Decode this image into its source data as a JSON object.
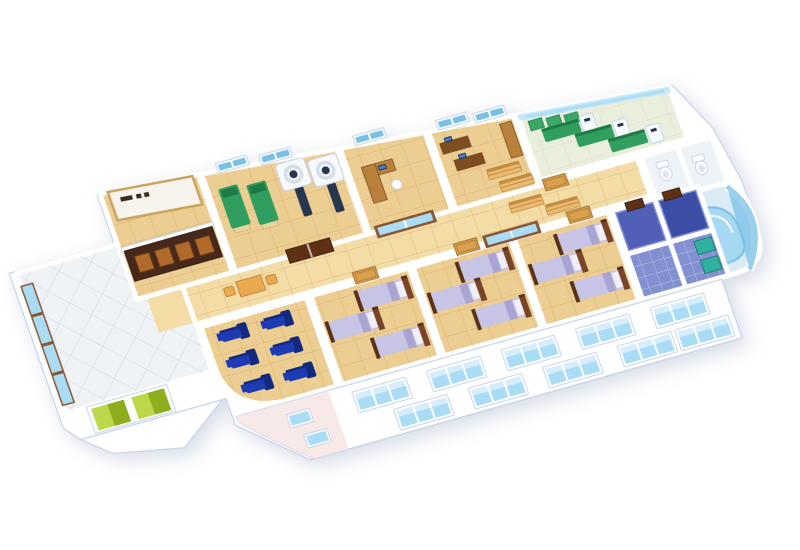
{
  "meta": {
    "description": "3D isometric cutaway floor-plan render of a hospital ward floor on a white background",
    "view": "isometric cutaway, rotated about -19 degrees",
    "reception_sign_text_legible": false
  },
  "colors": {
    "page_bg": "#ffffff",
    "slab": "#ffffff",
    "wall_edge": "#c7d4e8",
    "floor_tan": "#eccd92",
    "floor_grid": "#c89a52",
    "corridor_tan": "#f3dca6",
    "lobby_floor": "#f0f3f6",
    "lobby_grid": "#c6cfda",
    "glass": "#aadcf5",
    "glass_light": "#d6eefb",
    "glass_dark": "#79c0e6",
    "frame_brown": "#8a5633",
    "door_brown": "#5f3014",
    "door_tan": "#d9a14f",
    "exam_green": "#2f9e5f",
    "exam_green_dark": "#1e7a45",
    "base_wood": "#e9d3a0",
    "scanner_white": "#f7fafd",
    "scanner_dark": "#26364f",
    "scanner_ring": "#d4dde8",
    "desk_wood": "#b9803c",
    "desk_dark": "#7c4e22",
    "monitor": "#3e82dd",
    "bench": "#e9ba72",
    "bench_dark": "#c48c3f",
    "treat_wall": "#c3e9f7",
    "treat_floor": "#eaefdd",
    "screen_green": "#3aa868",
    "wc_floor": "#eef3f8",
    "pool_deck": "#d9ecf6",
    "pool_water": "#a7d8f3",
    "pool_deep": "#7cc0e7",
    "pool_rim": "#f2f9fd",
    "recliner": "#1d3cb4",
    "recliner_deep": "#12297f",
    "bed_wood": "#7a4426",
    "bed_wood_dark": "#5a3016",
    "blanket": "#c8c4e5",
    "blanket_dark": "#a9a4d1",
    "pillow": "#f1eff9",
    "bath_floor": "#8290d1",
    "bath_deep": "#5160b6",
    "navy": "#3c4da6",
    "teal": "#2fb0a0",
    "elev_green": "#bcd84a",
    "elev_dark": "#8fae1e",
    "pink": "#f7e5e5",
    "sign_bg": "#f7f4ee",
    "sign_ink": "#3a2c1d",
    "counter": "#46291a",
    "counter_panel": "#b06a2c",
    "table_orange": "#e9a94f",
    "table_dark": "#b97a2e"
  },
  "building": {
    "rooms": [
      {
        "id": "lobby",
        "name": "entrance-lobby",
        "floor": "white-diagonal-tile",
        "features": [
          "reception-counter",
          "reception-sign",
          "window-wall",
          "elevator-doors"
        ]
      },
      {
        "id": "imaging-room",
        "name": "imaging-room",
        "floor": "tan-tile",
        "furniture": [
          {
            "type": "exam-bed-green",
            "count": 2
          },
          {
            "type": "ct-scanner",
            "count": 2
          },
          {
            "type": "double-door-brown",
            "count": 1
          },
          {
            "type": "back-wall-window",
            "count": 2
          }
        ]
      },
      {
        "id": "consult-office",
        "name": "consultation-office",
        "floor": "tan-tile",
        "furniture": [
          {
            "type": "desk-l-shaped",
            "count": 1
          },
          {
            "type": "computer-monitor",
            "count": 1
          },
          {
            "type": "office-chair",
            "count": 1
          },
          {
            "type": "glass-sliding-door",
            "count": 1
          },
          {
            "type": "back-wall-window",
            "count": 1
          }
        ]
      },
      {
        "id": "staff-office",
        "name": "staff-office",
        "floor": "tan-tile",
        "furniture": [
          {
            "type": "desk-dark",
            "count": 2
          },
          {
            "type": "computer-monitor",
            "count": 2
          },
          {
            "type": "bench-wood",
            "count": 2
          },
          {
            "type": "storage-counter",
            "count": 1
          },
          {
            "type": "back-wall-window",
            "count": 2
          }
        ]
      },
      {
        "id": "treatment-room",
        "name": "physiotherapy-treatment-room",
        "floor": "pale-green-tile",
        "furniture": [
          {
            "type": "treatment-table-green",
            "count": 3
          },
          {
            "type": "medical-device-white",
            "count": 3
          },
          {
            "type": "privacy-screen-green",
            "count": 3
          }
        ]
      },
      {
        "id": "restrooms",
        "name": "restrooms",
        "floor": "white-tile",
        "furniture": [
          {
            "type": "toilet",
            "count": 2
          }
        ]
      },
      {
        "id": "pool",
        "name": "hydrotherapy-pool",
        "floor": "pool-deck",
        "features": [
          "curved-pool-water",
          "curved-glass-wall"
        ]
      },
      {
        "id": "corridor",
        "name": "corridor",
        "floor": "tan-tile",
        "furniture": [
          {
            "type": "bench-wood",
            "count": 2
          },
          {
            "type": "table-orange",
            "count": 1
          },
          {
            "type": "chair-orange",
            "count": 2
          },
          {
            "type": "door-tan",
            "count": 4
          }
        ]
      },
      {
        "id": "infusion-room",
        "name": "infusion-room",
        "floor": "tan-tile",
        "furniture": [
          {
            "type": "recliner-blue",
            "count": 6
          }
        ]
      },
      {
        "id": "ward-1",
        "name": "patient-ward-1",
        "floor": "tan-tile",
        "furniture": [
          {
            "type": "bed-lavender",
            "count": 3
          }
        ]
      },
      {
        "id": "ward-2",
        "name": "patient-ward-2",
        "floor": "tan-tile",
        "furniture": [
          {
            "type": "bed-lavender",
            "count": 3
          }
        ]
      },
      {
        "id": "ward-3",
        "name": "patient-ward-3",
        "floor": "tan-tile",
        "furniture": [
          {
            "type": "bed-lavender",
            "count": 3
          }
        ]
      },
      {
        "id": "bathrooms",
        "name": "bathrooms",
        "floor": "blue-tile",
        "furniture": [
          {
            "type": "shower-unit-teal",
            "count": 2
          },
          {
            "type": "door-brown",
            "count": 2
          }
        ]
      }
    ],
    "exterior": {
      "facade_windows_upper": 5,
      "facade_windows_lower": 5,
      "small_windows_pink_wall": 2,
      "lobby_window_columns": 1,
      "elevator_doors": 2,
      "pink_wall_section": 1
    }
  }
}
